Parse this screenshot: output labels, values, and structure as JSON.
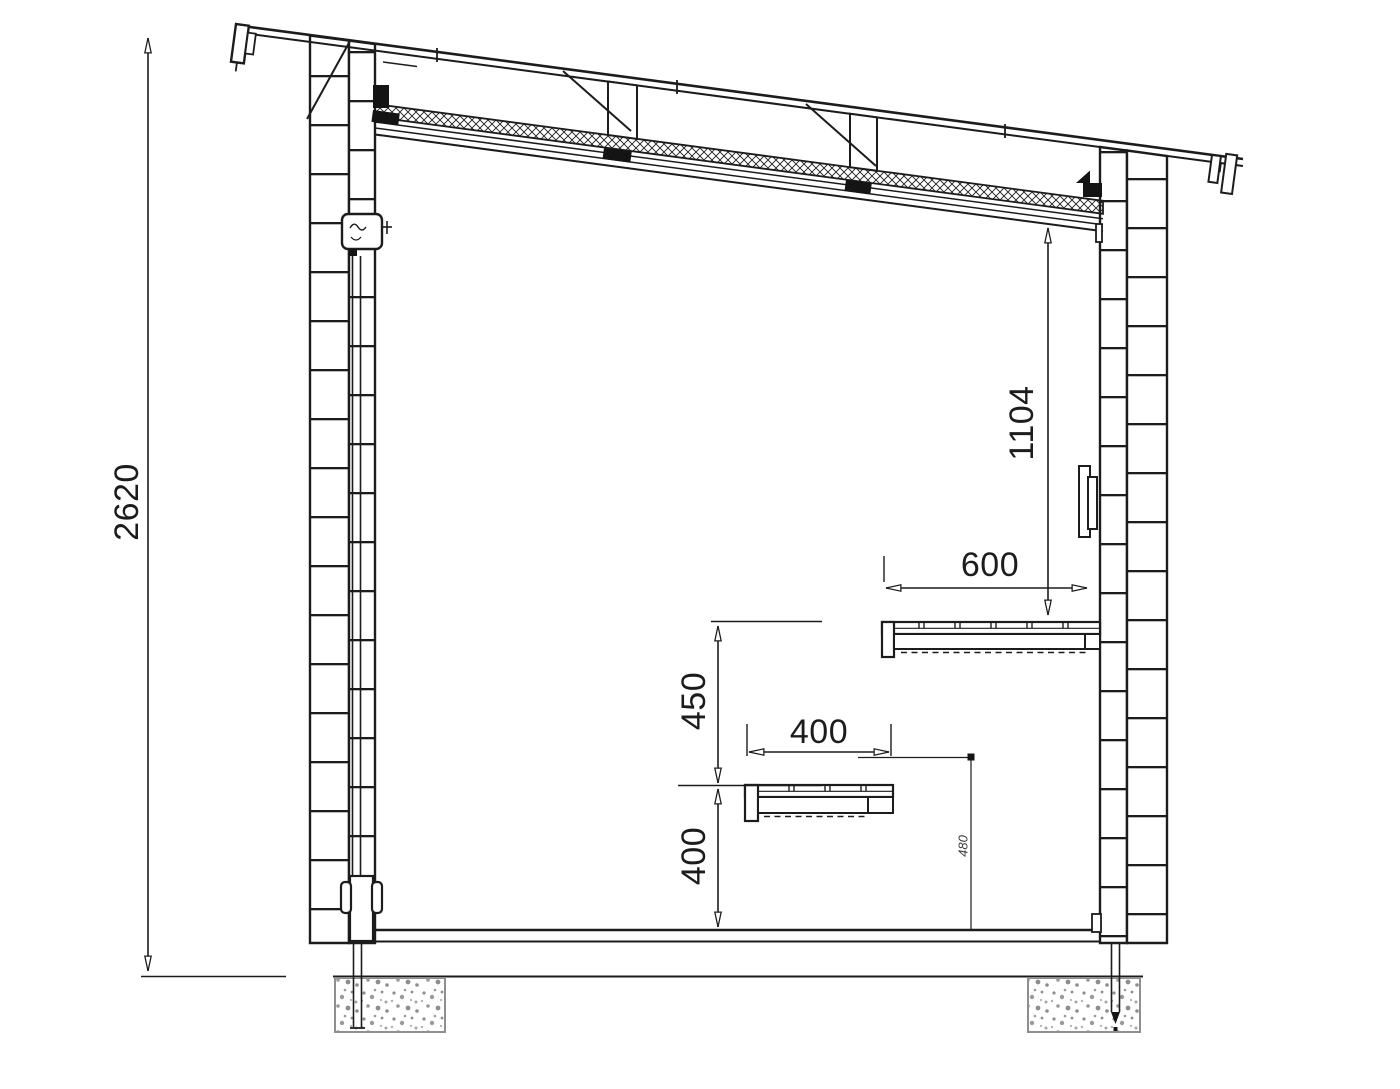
{
  "drawing": {
    "description": "Sauna / shed cross-section technical drawing",
    "colors": {
      "line": "#1c1c1c",
      "foundation_border": "#8f8f8f",
      "paper": "#ffffff"
    }
  },
  "dimensions": {
    "wall_height": "2620",
    "ceiling_to_upper_bench": "1104",
    "upper_bench_depth": "600",
    "bench_vertical_gap": "450",
    "lower_bench_depth": "400",
    "lower_bench_height": "400",
    "rail_height": "480"
  }
}
